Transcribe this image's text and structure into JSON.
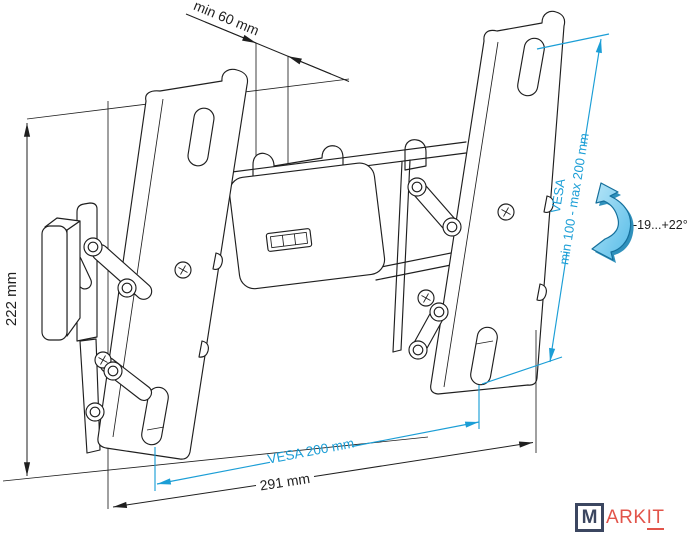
{
  "drawing": {
    "type": "technical-line-drawing",
    "subject": "Tilting TV wall mount bracket — dimensional diagram"
  },
  "dimensions": {
    "wall_clearance": "min 60 mm",
    "bracket_height": "222 mm",
    "total_width": "291 mm",
    "vesa_width": "VESA 200 mm",
    "vesa_height_title": "VESA",
    "vesa_height_range": "min 100 - max 200 mm",
    "tilt_range": "-19...+22°"
  },
  "logo": {
    "initial": "M",
    "text": "ARK",
    "underlined": "IT"
  },
  "colors": {
    "line": "#1f1f1f",
    "accent": "#1b9ed6",
    "arrow-light": "#b8e6f8",
    "arrow-mid": "#56bce8",
    "arrow-dark": "#1a85b5",
    "arrow-stroke": "#156f9b",
    "logo-navy": "#3b4660",
    "logo-red": "#e2544a",
    "background": "#ffffff"
  }
}
